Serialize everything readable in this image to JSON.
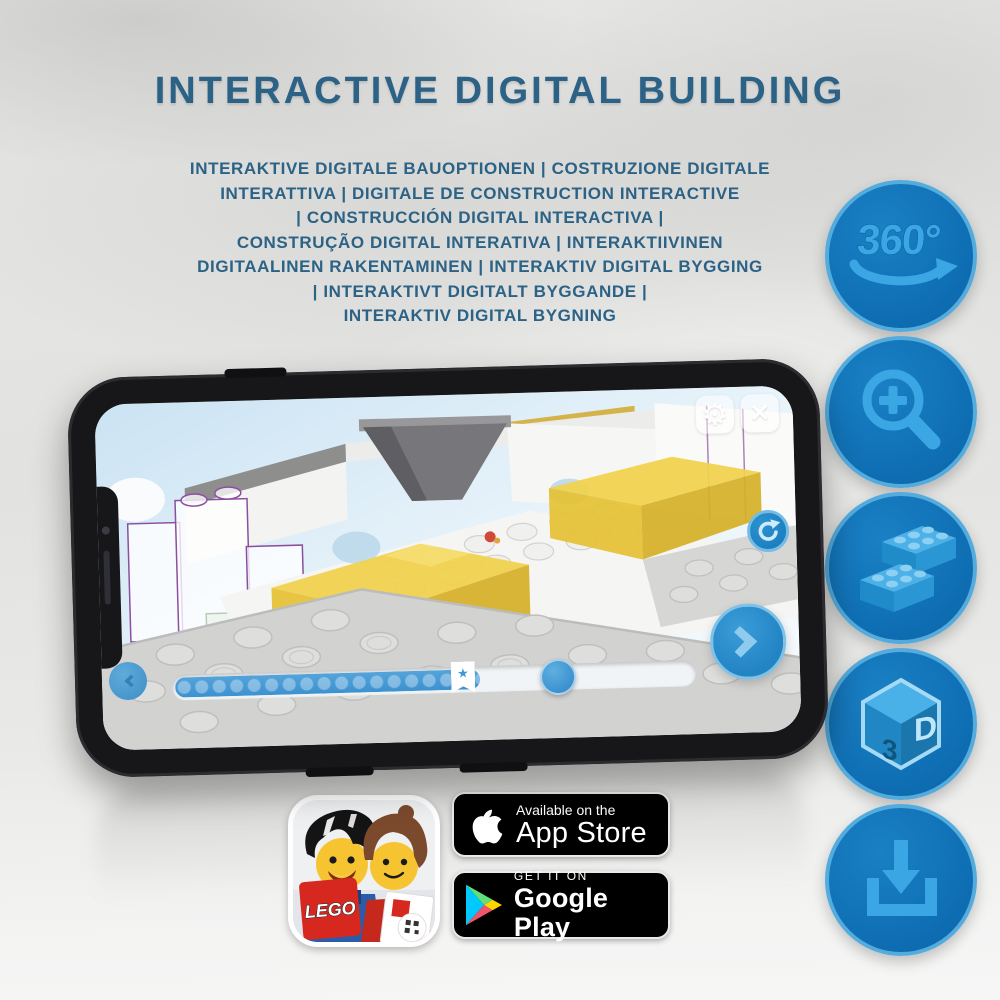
{
  "page": {
    "title": "INTERACTIVE DIGITAL BUILDING",
    "subtitle": "INTERAKTIVE DIGITALE BAUOPTIONEN | COSTRUZIONE DIGITALE\nINTERATTIVA | DIGITALE DE CONSTRUCTION INTERACTIVE\n| CONSTRUCCIÓN DIGITAL INTERACTIVA |\nCONSTRUÇÃO DIGITAL INTERATIVA | INTERAKTIIVINEN\nDIGITAALINEN RAKENTAMINEN | INTERAKTIV DIGITAL BYGGING\n| INTERAKTIVT DIGITALT BYGGANDE |\nINTERAKTIV DIGITAL BYGNING"
  },
  "feature_icons": {
    "rotate360": {
      "label": "360°"
    },
    "zoom_in": {
      "name": "zoom-in-magnifier"
    },
    "bricks": {
      "name": "building-bricks"
    },
    "cube3d": {
      "left_face": "3",
      "right_face": "D"
    },
    "download": {
      "name": "download-arrow"
    }
  },
  "phone_app": {
    "settings_glyph": "⚙",
    "close_glyph": "✕",
    "bookmark_glyph": "★",
    "progress_percent": 62
  },
  "store": {
    "lego_logo": "LEGO",
    "app_store": {
      "tagline": "Available on the",
      "store_name": "App Store"
    },
    "google_play": {
      "tagline": "GET IT ON",
      "store_name": "Google Play"
    }
  },
  "colors": {
    "heading_blue": "#2b6286",
    "icon_circle_blue": "#0f6fb4",
    "icon_glyph_blue": "#3aa6e4",
    "app_ui_blue": "#3c93d0",
    "brick_yellow": "#eecf4a"
  }
}
